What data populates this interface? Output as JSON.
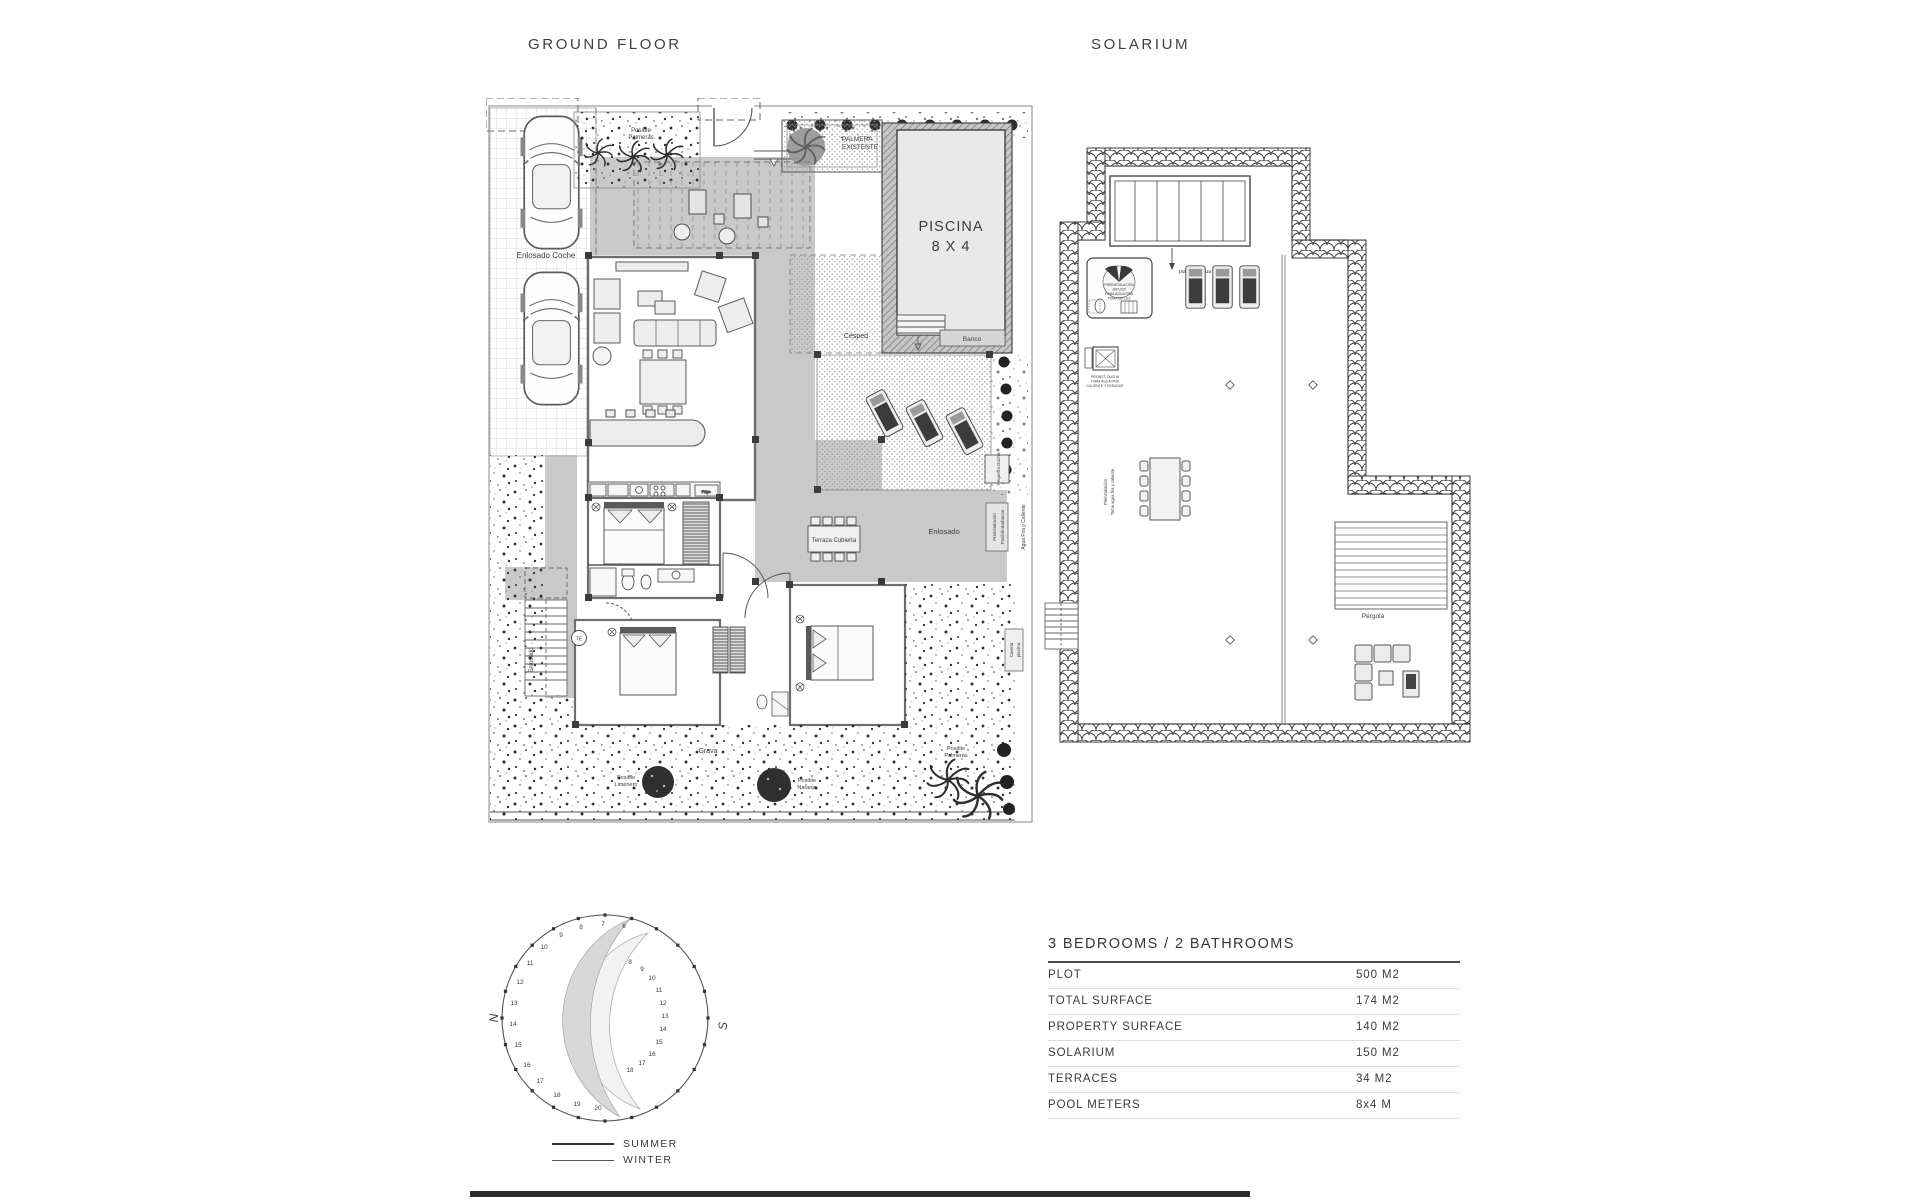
{
  "titles": {
    "ground_floor": "GROUND FLOOR",
    "solarium": "SOLARIUM"
  },
  "ground_floor": {
    "labels": {
      "enlosado_coche": "Enlosado Coche",
      "posible_palmeras_top": [
        "Posible",
        "Palmeras"
      ],
      "palmera_existente": [
        "PALMERA",
        "EXISTENTE"
      ],
      "piscina": "PISCINA",
      "piscina_dim": "8 X 4",
      "banco": "Banco",
      "cesped": "Césped",
      "enlosado_terrace": "Enlosado",
      "enlosado_left": "Enlosado",
      "pequena_ducha": "Pequeña Ducha",
      "preinstalacion": [
        "Preinstalación",
        "Posible Barbacoa"
      ],
      "agua_fria": "Agua Fria y Caliente",
      "caseta_piscina": [
        "Caseta",
        "piscina"
      ],
      "terraza_cubierta": "Terraza Cubierta",
      "grava": "Grava",
      "posible_limonero": [
        "Posible",
        "Limonero"
      ],
      "posible_naranjo": [
        "Posible",
        "Naranjo"
      ],
      "posible_palmeras_bottom": [
        "Posible",
        "Palmeras"
      ],
      "te": "TE",
      "frigo": "Frigo"
    }
  },
  "solarium": {
    "labels": {
      "punto_de_agua": "punto de agua",
      "jacuzzi": [
        "PREINSTALACION",
        "JACUZZI",
        "TOMA AGUA FRIA",
        "TOMA DE LUZ"
      ],
      "ducha": [
        "PREINST. DUCHA",
        "TOMA AGUA FRIA",
        "CALIENTE Y DESAGUE"
      ],
      "vertical": [
        "Preinstalación",
        "Toma agua fria y caliente"
      ],
      "pergola": "Pérgola"
    }
  },
  "sun_diagram": {
    "north": "N",
    "south": "S",
    "summer": "SUMMER",
    "winter": "WINTER",
    "summer_hours": [
      [
        6,
        144,
        33
      ],
      [
        7,
        123,
        31
      ],
      [
        8,
        101,
        34
      ],
      [
        9,
        81,
        42
      ],
      [
        10,
        64,
        54
      ],
      [
        11,
        50,
        70
      ],
      [
        12,
        40,
        89
      ],
      [
        13,
        34,
        110
      ],
      [
        14,
        33,
        131
      ],
      [
        15,
        38,
        152
      ],
      [
        16,
        47,
        172
      ],
      [
        17,
        60,
        188
      ],
      [
        18,
        77,
        202
      ],
      [
        19,
        97,
        211
      ],
      [
        20,
        118,
        215
      ]
    ],
    "winter_hours": [
      [
        8,
        150,
        69
      ],
      [
        9,
        162,
        76
      ],
      [
        10,
        172,
        85
      ],
      [
        11,
        179,
        97
      ],
      [
        12,
        183,
        110
      ],
      [
        13,
        185,
        123
      ],
      [
        14,
        183,
        136
      ],
      [
        15,
        179,
        149
      ],
      [
        16,
        172,
        161
      ],
      [
        17,
        162,
        170
      ],
      [
        18,
        150,
        177
      ]
    ]
  },
  "spec_table": {
    "title": "3 BEDROOMS / 2 BATHROOMS",
    "rows": [
      {
        "label": "PLOT",
        "value": "500 M2"
      },
      {
        "label": "TOTAL SURFACE",
        "value": "174 M2"
      },
      {
        "label": "PROPERTY SURFACE",
        "value": "140 M2"
      },
      {
        "label": "SOLARIUM",
        "value": "150 M2"
      },
      {
        "label": "TERRACES",
        "value": "34 M2"
      },
      {
        "label": "POOL METERS",
        "value": "8x4 M"
      }
    ]
  }
}
